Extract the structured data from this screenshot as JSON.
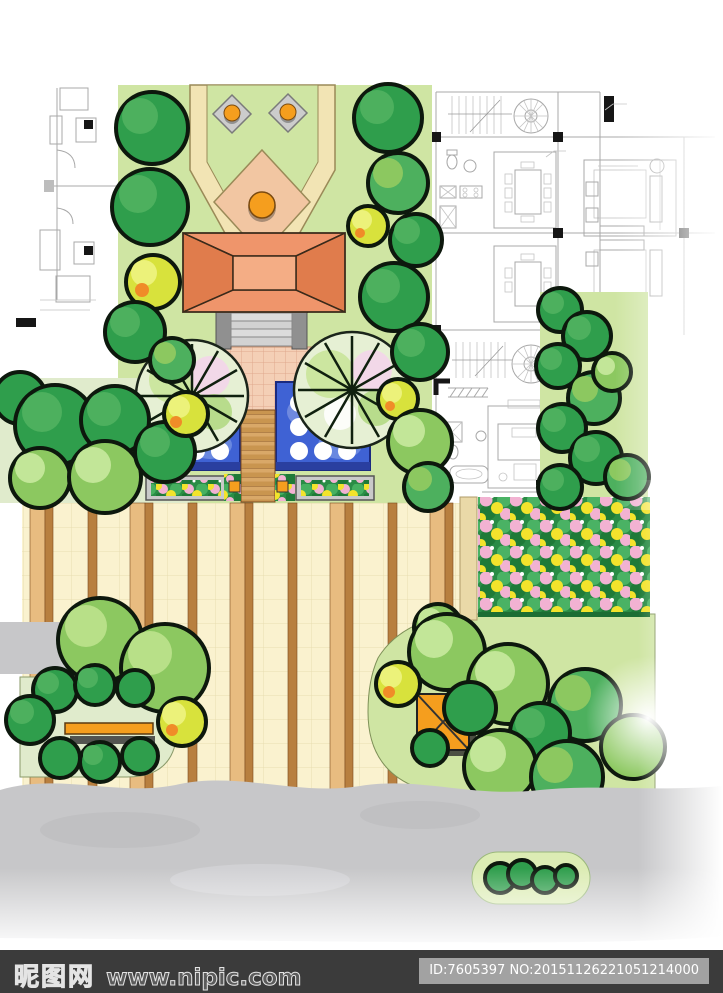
{
  "footer": {
    "site_logo": "昵图网",
    "site_url": "www.nipic.com",
    "image_id": "ID:7605397 NO:20151126221051214000"
  },
  "colors": {
    "lawn": "#cfe5a3",
    "lawn_pale": "#e0ebcc",
    "path_cream": "#f2e4b4",
    "peach": "#f2c6a2",
    "roof_main": "#ef956b",
    "roof_dark": "#e07c4c",
    "roof_light": "#f4ad85",
    "pool_blue": "#3f62d4",
    "pool_deep": "#2a3fa0",
    "paving": "#faf2cf",
    "stripe_tan": "#e8bc80",
    "stripe_brown": "#b87f3f",
    "plaza_pink": "#f4cfb6",
    "tree_dark": "#2f9e4c",
    "tree_mid": "#4db05e",
    "tree_light": "#8cc860",
    "bush_yellow": "#d8e23c",
    "flower_green": "#2a8c46",
    "flower_pink": "#f2b2d2",
    "flower_yellow": "#f3e32c",
    "accent_orange": "#f59e1e",
    "road_gray": "#c7c7c9",
    "cad_line": "#a8a8a8",
    "footer_bg": "#3b3b3b",
    "badge_bg": "#a2a2a2"
  }
}
